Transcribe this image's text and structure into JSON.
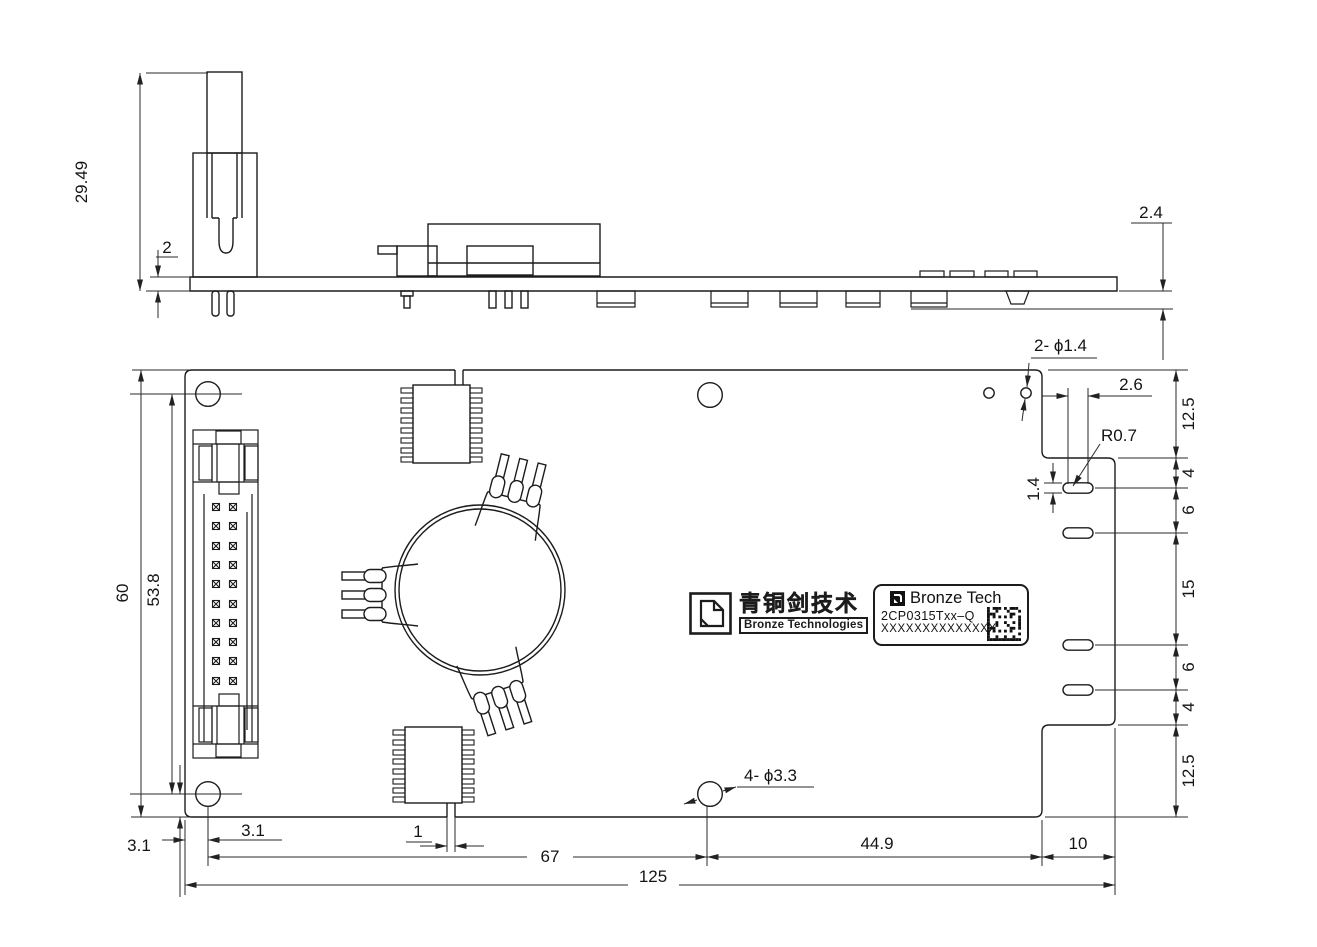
{
  "drawing": {
    "side_view": {
      "connector_height": "29.49",
      "board_thickness": "2",
      "underside_height": "2.4"
    },
    "plan_view": {
      "board_height": "60",
      "hole_span_v": "53.8",
      "hole_offset_left": "3.1",
      "hole_offset_bottom": "3.1",
      "slot_width": "1",
      "hole_span_h": "67",
      "hole_to_notch": "44.9",
      "notch_width": "10",
      "board_width": "125",
      "small_holes_label": "2- ϕ1.4",
      "mount_holes_label": "4- ϕ3.3",
      "slot_pitch": "2.6",
      "slot_end_radius": "R0.7",
      "slot_height": "1.4",
      "right_chain": [
        "12.5",
        "4",
        "6",
        "15",
        "6",
        "4",
        "12.5"
      ]
    },
    "branding": {
      "logo_cn": "青铜剑技术",
      "logo_en": "Bronze Technologies",
      "label_brand": "Bronze Tech",
      "label_part": "2CP0315Txx–Q",
      "label_serial": "XXXXXXXXXXXXXX"
    }
  }
}
